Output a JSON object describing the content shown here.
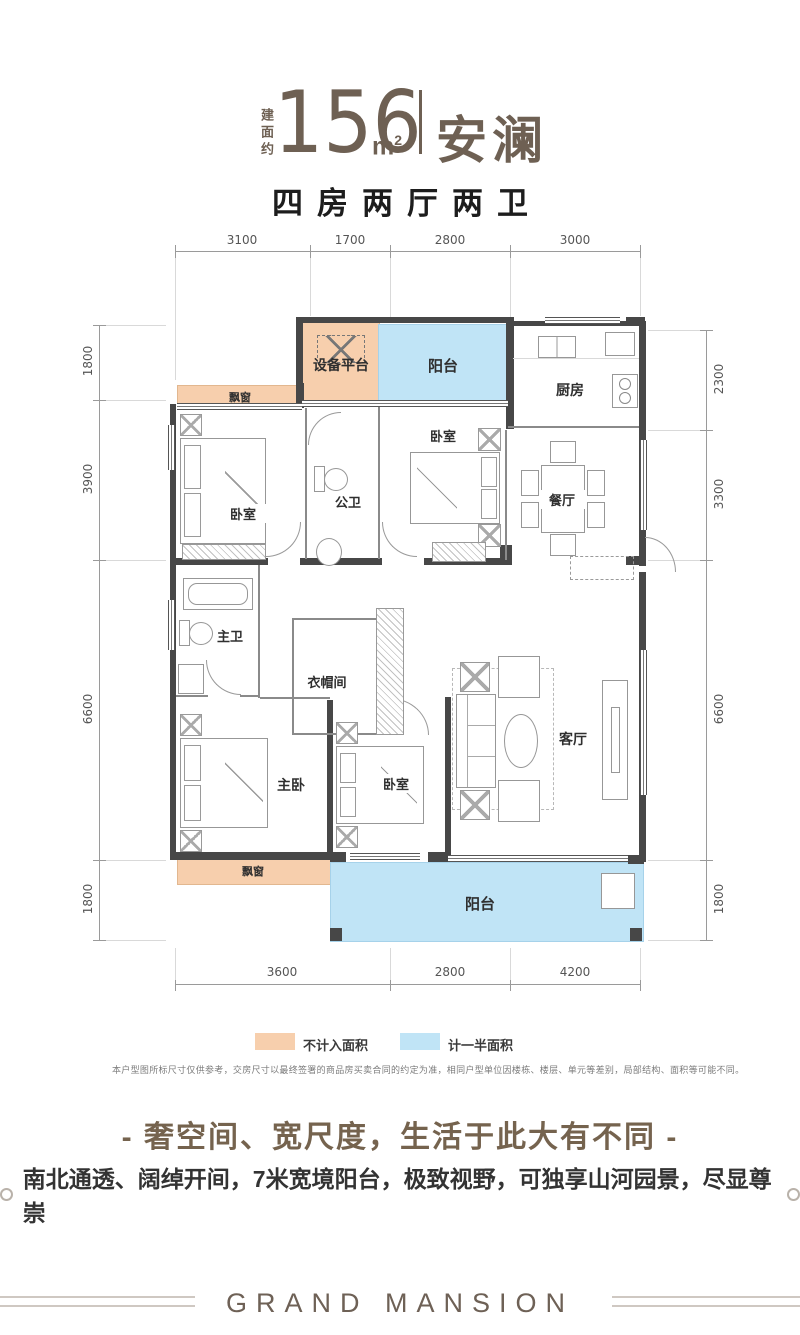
{
  "header": {
    "area_prefix": "建面约",
    "area_value": "156",
    "area_unit": "m",
    "area_sup": "2",
    "name": "安澜",
    "layout_desc": "四房两厅两卫"
  },
  "plan": {
    "dims_top": [
      "3100",
      "1700",
      "2800",
      "3000"
    ],
    "dims_left": [
      "1800",
      "3900",
      "6600",
      "1800"
    ],
    "dims_right": [
      "2300",
      "3300",
      "6600",
      "1800"
    ],
    "dims_bottom": [
      "3600",
      "2800",
      "4200"
    ],
    "rooms": {
      "equipment": "设备平台",
      "balcony_top": "阳台",
      "kitchen": "厨房",
      "bay_top": "飘窗",
      "bedroom_left": "卧室",
      "bath_public": "公卫",
      "bedroom_mid": "卧室",
      "dining": "餐厅",
      "bath_master": "主卫",
      "closet": "衣帽间",
      "master": "主卧",
      "bedroom_bottom": "卧室",
      "living": "客厅",
      "bay_bottom": "飘窗",
      "balcony_bottom": "阳台"
    }
  },
  "legend": {
    "items": [
      {
        "label": "不计入面积",
        "color": "#f7cfad"
      },
      {
        "label": "计一半面积",
        "color": "#c0e4f6"
      }
    ]
  },
  "disclaimer": "本户型图所标尺寸仅供参考，交房尺寸以最终签署的商品房买卖合同的约定为准，相同户型单位因楼栋、楼层、单元等差别，局部结构、面积等可能不同。",
  "marketing": {
    "headline": "- 奢空间、宽尺度，生活于此大有不同 -",
    "subline": "南北通透、阔绰开间，7米宽境阳台，极致视野，可独享山河园景，尽显尊崇"
  },
  "footer": {
    "brand": "GRAND MANSION"
  },
  "colors": {
    "accent_brown": "#6e6053",
    "not_counted": "#f7cfad",
    "half_counted": "#c0e4f6"
  }
}
